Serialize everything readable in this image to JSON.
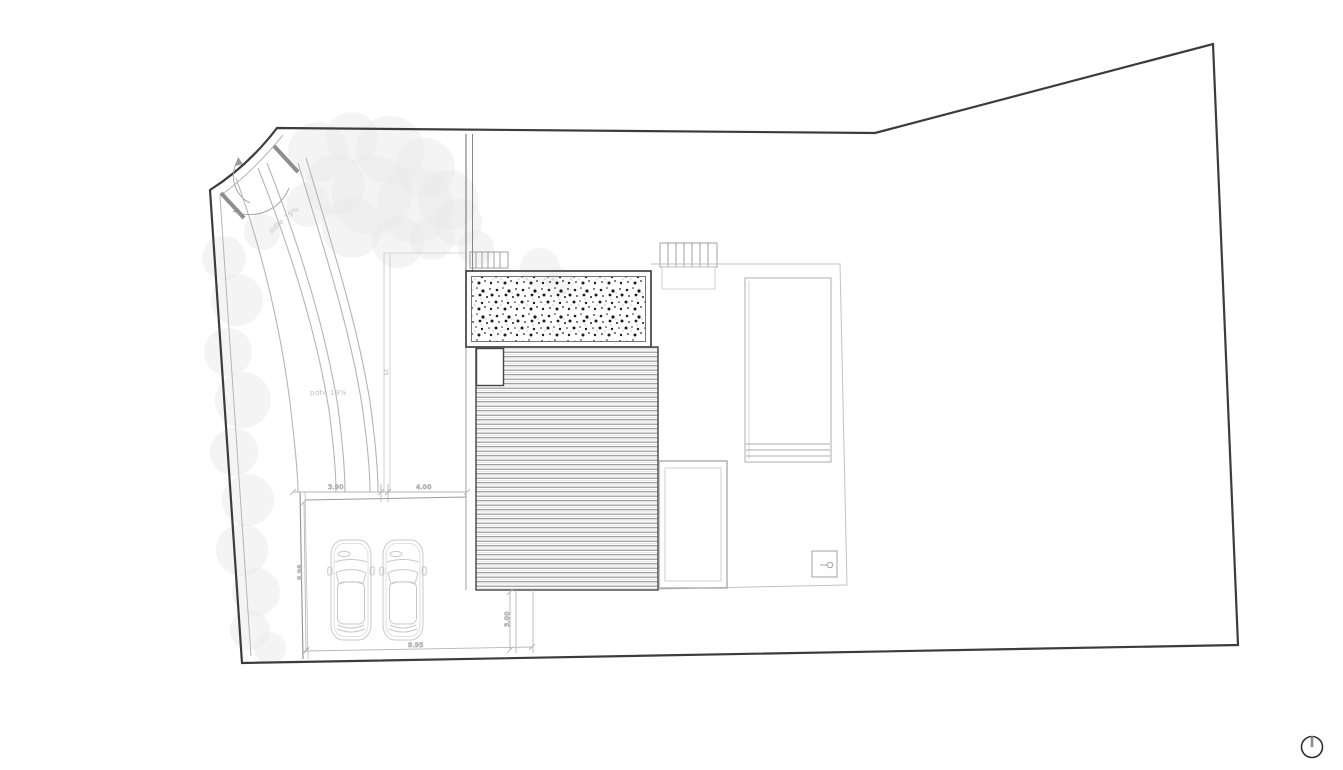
{
  "page": {
    "background": "#ffffff"
  },
  "plan": {
    "slope_label_upper": "pdte 19%",
    "slope_label_lower": "pdte 19%",
    "dim_parking_left": "3.90",
    "dim_parking_right": "4.00",
    "dim_parking_depth": "8.98",
    "dim_parking_total": "9.95",
    "dim_rear_path": "3.00",
    "dim_edge_detail": "25"
  },
  "icons": {
    "north_arrow": "north-arrow"
  },
  "colors": {
    "boundary_ink": "#3c3c3c",
    "building_ink": "#6b6b6b",
    "heavy_ink": "#454545",
    "light_ink": "#b5b5b5",
    "faint_ink": "#d2d2d2",
    "gate_ink": "#8e8e8e",
    "car_ink": "#c9c9c9",
    "tree_fill": "#e9e9e9",
    "deck_stripe": "#8c8c8c",
    "dim_text": "#ababab"
  }
}
